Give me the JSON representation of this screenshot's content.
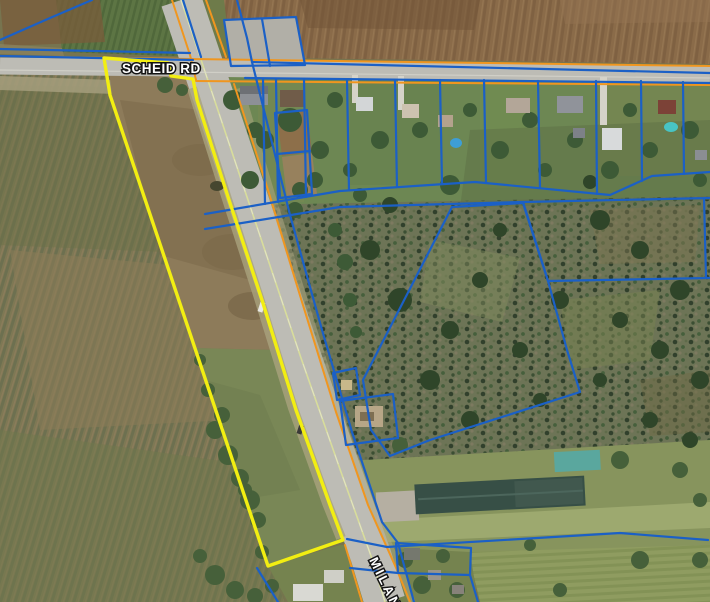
{
  "map": {
    "labels": {
      "scheid": "SCHEID RD",
      "milan": "MILAN"
    },
    "colors": {
      "parcel_line": "#1b60c6",
      "road_casing": "#f0961f",
      "selected_parcel": "#f2ee12",
      "label_fill": "#ffffff",
      "label_outline": "#141414"
    }
  }
}
